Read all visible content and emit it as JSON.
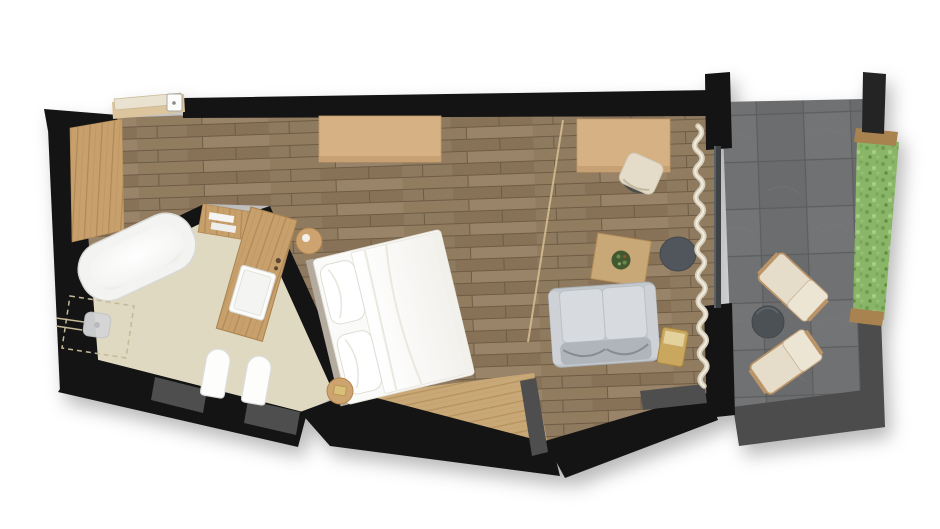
{
  "title": "Hotel room floor plan - top view render",
  "scene": {
    "rooms": [
      {
        "name": "bedroom",
        "floor": "oak plank flooring",
        "items": [
          "entry door",
          "wardrobe panel",
          "sideboard",
          "double bed with white duvet and two pillows",
          "round nightstand at head",
          "round nightstand at foot",
          "desk",
          "desk chair",
          "coffee table with plant",
          "dark pouf",
          "gray two-seat sofa",
          "brass side table",
          "curtain along glass wall",
          "ceiling slope line"
        ]
      },
      {
        "name": "bathroom",
        "floor": "beige stone floor",
        "items": [
          "bathtub",
          "walk-in shower with shower head",
          "toilet",
          "bidet",
          "wood vanity with white sink",
          "towel shelf"
        ]
      },
      {
        "name": "balcony",
        "floor": "dark stone tiles",
        "items": [
          "lounge chair upper",
          "lounge chair lower",
          "round outdoor table",
          "green hedge planter",
          "railing"
        ]
      }
    ],
    "openings": [
      "entry door at top-left",
      "glass wall with balcony door on the right",
      "windows in the bottom wall",
      "glazed panels in the bathroom bottom wall"
    ]
  },
  "palette": {
    "wall": "#141414",
    "wall_dark2": "#242424",
    "wood_floor": "#8d785c",
    "light_wood": "#c9a877",
    "furniture_wood": "#d6b183",
    "vanity_wood": "#c7a06c",
    "bathroom_floor": "#e0d9c1",
    "balcony_stone": "#6f6f6f",
    "railing": "#4c4c4c",
    "hedge_green": "#8ab568",
    "textile_white": "#fafaf8",
    "sofa_gray": "#c3c8cd",
    "pouf_gray": "#50565c",
    "curtain": "#d6cebb",
    "glass": "#3e4244",
    "brass": "#c9a75f",
    "window_panel": "#4e4e4e",
    "background": "#ffffff"
  }
}
